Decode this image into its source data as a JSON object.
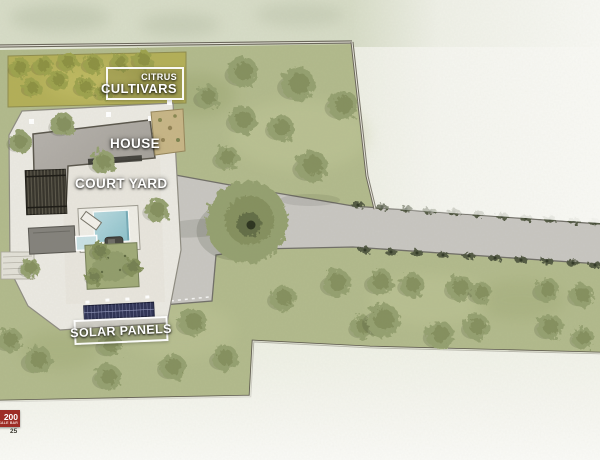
{
  "labels": {
    "citrus_line1": "CITRUS",
    "citrus_line2": "CULTIVARS",
    "house": "HOUSE",
    "courtyard": "COURT YARD",
    "solar": "SOLAR PANELS"
  },
  "scale_badge": {
    "value": "200",
    "caption": "SCALE BAR",
    "number_below": "25",
    "color": "#9d2c26"
  },
  "colors": {
    "lawn": "#b2ba8c",
    "citrus_field": "#b3af58",
    "road": "#c8c6c1",
    "compound": "#ebe9e2",
    "roof": "#aba7a1",
    "pergola": "#36332b",
    "pool": "#a9d0d8",
    "solar_panel": "#2f3356",
    "tree_base": "#95a06f",
    "tree_dark": "#76814f",
    "citrus_tree_base": "#9da24e",
    "citrus_tree_dark": "#7c8138",
    "bush": "#4f5640",
    "boundary": "#5f5b50"
  },
  "features": {
    "trees_citrus": [
      [
        20,
        68,
        10
      ],
      [
        43,
        66,
        10
      ],
      [
        68,
        62,
        10
      ],
      [
        93,
        64,
        10
      ],
      [
        120,
        62,
        9
      ],
      [
        143,
        60,
        10
      ],
      [
        32,
        88,
        9
      ],
      [
        58,
        80,
        10
      ],
      [
        85,
        87,
        10
      ],
      [
        103,
        93,
        8
      ]
    ],
    "trees_lawn": [
      [
        208,
        97,
        12
      ],
      [
        243,
        72,
        15
      ],
      [
        298,
        84,
        17
      ],
      [
        343,
        105,
        15
      ],
      [
        243,
        120,
        14
      ],
      [
        281,
        128,
        13
      ],
      [
        227,
        158,
        12
      ],
      [
        312,
        166,
        16
      ],
      [
        63,
        125,
        12
      ],
      [
        20,
        142,
        11
      ],
      [
        103,
        162,
        12
      ],
      [
        157,
        210,
        12
      ],
      [
        30,
        268,
        10
      ],
      [
        10,
        340,
        12
      ],
      [
        38,
        360,
        14
      ],
      [
        110,
        345,
        12
      ],
      [
        108,
        377,
        13
      ],
      [
        173,
        367,
        13
      ],
      [
        193,
        322,
        14
      ],
      [
        225,
        358,
        13
      ],
      [
        283,
        298,
        13
      ],
      [
        337,
        283,
        14
      ],
      [
        363,
        327,
        12
      ],
      [
        380,
        282,
        13
      ],
      [
        412,
        285,
        12
      ],
      [
        460,
        288,
        13
      ],
      [
        481,
        293,
        11
      ],
      [
        547,
        290,
        12
      ],
      [
        582,
        295,
        12
      ],
      [
        383,
        320,
        17
      ],
      [
        440,
        335,
        14
      ],
      [
        477,
        327,
        13
      ],
      [
        550,
        327,
        13
      ],
      [
        583,
        338,
        11
      ]
    ],
    "trees_garden": [
      [
        100,
        251,
        9
      ],
      [
        133,
        267,
        9
      ],
      [
        94,
        277,
        8
      ]
    ],
    "tree_big": [
      247,
      222,
      41
    ],
    "bushes_top": [
      [
        358,
        205
      ],
      [
        382,
        207
      ],
      [
        406,
        209
      ],
      [
        430,
        211
      ],
      [
        454,
        212
      ],
      [
        478,
        214
      ],
      [
        502,
        216
      ],
      [
        526,
        218
      ],
      [
        550,
        219
      ],
      [
        574,
        221
      ],
      [
        595,
        222
      ]
    ],
    "bushes_bottom": [
      [
        365,
        250
      ],
      [
        391,
        252
      ],
      [
        417,
        253
      ],
      [
        443,
        255
      ],
      [
        469,
        256
      ],
      [
        495,
        258
      ],
      [
        521,
        260
      ],
      [
        547,
        261
      ],
      [
        573,
        263
      ],
      [
        595,
        265
      ]
    ]
  }
}
